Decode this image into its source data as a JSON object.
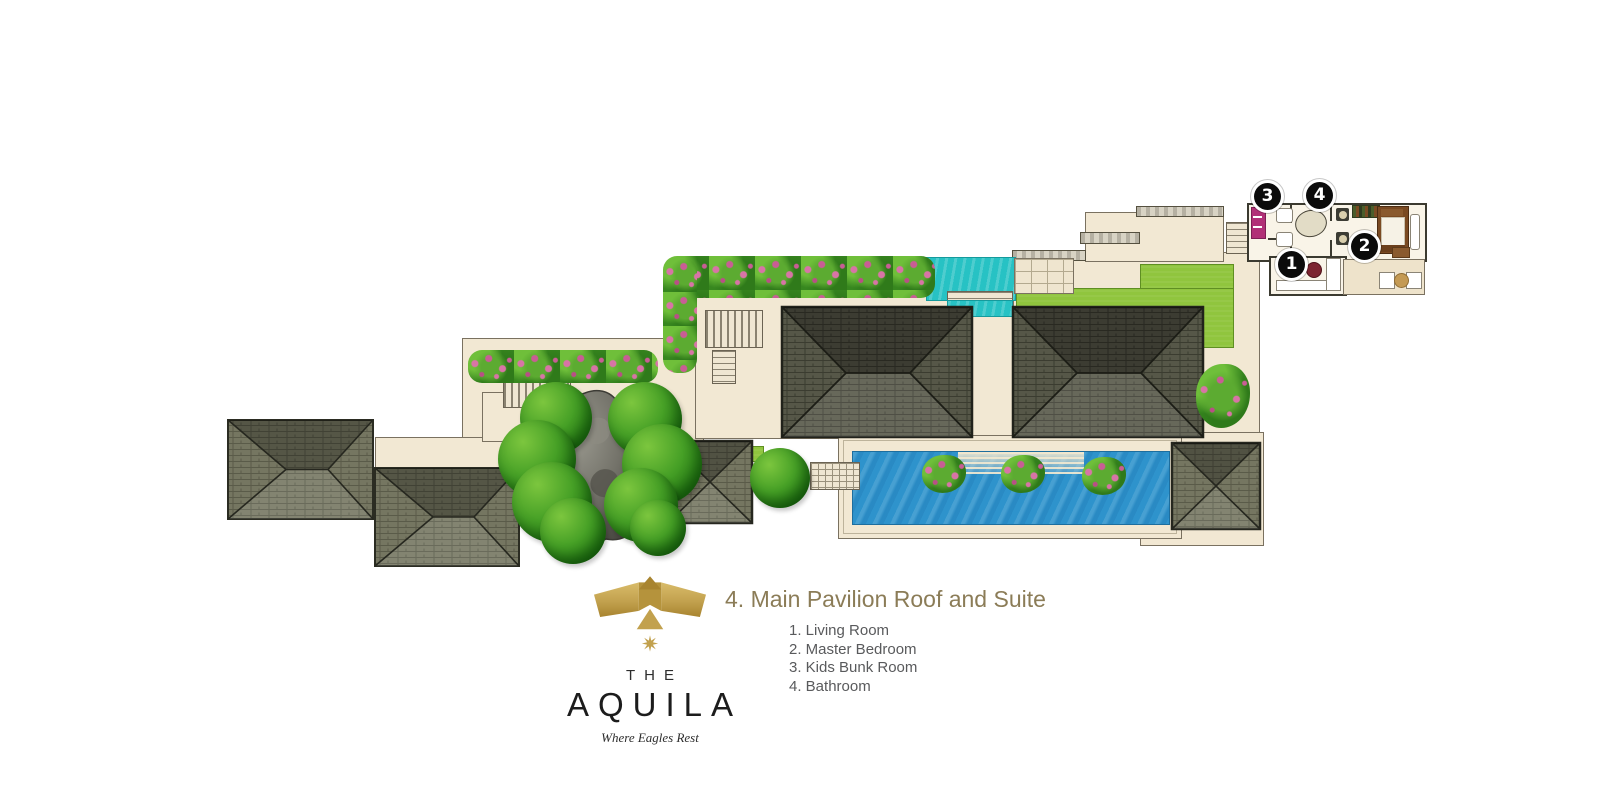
{
  "title": {
    "text": "4. Main Pavilion Roof and Suite"
  },
  "legend": {
    "items": [
      "1. Living Room",
      "2. Master Bedroom",
      "3. Kids Bunk Room",
      "4. Bathroom"
    ]
  },
  "branding": {
    "the": "THE",
    "name": "AQUILA",
    "tagline": "Where Eagles Rest"
  },
  "markers": [
    {
      "num": "1",
      "room": "Living Room"
    },
    {
      "num": "2",
      "room": "Master Bedroom"
    },
    {
      "num": "3",
      "room": "Kids Bunk Room"
    },
    {
      "num": "4",
      "room": "Bathroom"
    }
  ],
  "colors": {
    "terrace_cream": "#f2e8d3",
    "roof_shingle": "#73745f",
    "roof_shingle_dark": "#565748",
    "pool_blue": "#2e93cc",
    "plunge_teal": "#27c2c4",
    "lawn_green": "#90c53e",
    "flower_pink": "#d774a5",
    "tree_green": "#2f8f1d",
    "logo_gold": "#c2a14e",
    "title_gold": "#8b7c57",
    "legend_gray": "#595a5c",
    "marker_black": "#0b0b0b"
  }
}
